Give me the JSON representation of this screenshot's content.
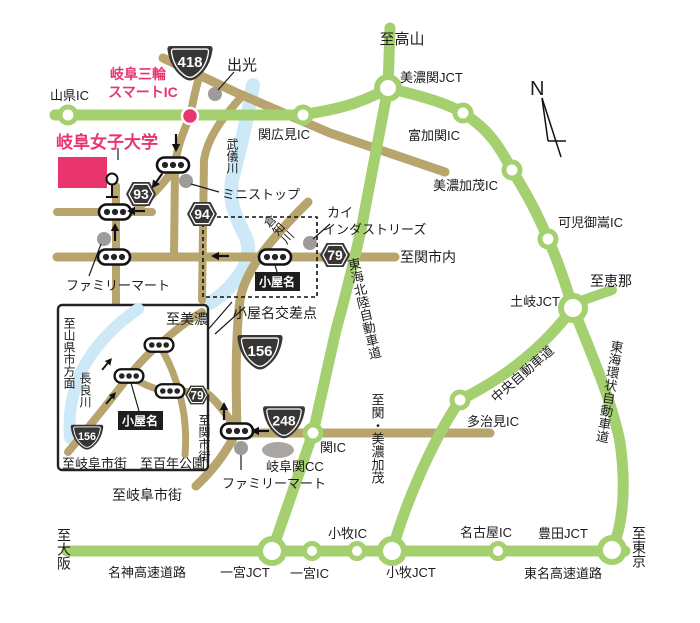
{
  "title": "岐阜女子大学 アクセスマップ",
  "colors": {
    "expressway_green": "#a4d070",
    "local_road_tan": "#b8a46d",
    "river_blue": "#cde9f7",
    "accent_pink": "#e8356d",
    "badge_dark": "#383634",
    "poi_gray": "#9e9b98"
  },
  "route_badges": {
    "national_routes": [
      "418",
      "156",
      "248"
    ],
    "prefectural_routes": [
      "93",
      "94",
      "79"
    ]
  },
  "labels": {
    "takayama": "至高山",
    "route_418": "418",
    "idemitsu": "出光",
    "gifu_miwa_line1": "岐阜三輪",
    "gifu_miwa_line2": "スマートIC",
    "yamagata_ic": "山県IC",
    "minoseki_jct": "美濃関JCT",
    "sekihiromi_ic": "関広見IC",
    "compass_n": "N",
    "tomikaseki_ic": "富加関IC",
    "gifu_womens_univ": "岐阜女子大学",
    "mukigawa": "武儀川",
    "ministop": "ミニストップ",
    "route_93": "93",
    "route_94": "94",
    "kai_line1": "カイ",
    "kai_line2": "インダストリーズ",
    "route_79": "79",
    "seki_shinai": "至関市内",
    "minokamo_ic": "美濃加茂IC",
    "kanimitake_ic": "可児御嵩IC",
    "ena": "至恵那",
    "toki_jct": "土岐JCT",
    "tokai_hokuriku": "東海北陸自動車道",
    "kurachigawa": "倉知川",
    "koyana": "小屋名",
    "koyana_kosaten": "小屋名交差点",
    "familymart_left": "ファミリーマート",
    "tokai_kanjo": "東海環状自動車道",
    "chuo_expwy": "中央自動車道",
    "tajimi_ic": "多治見IC",
    "route_156": "156",
    "route_248": "248",
    "seki_ic": "関IC",
    "gifuseki_cc": "岐阜関CC",
    "familymart_bottom": "ファミリーマート",
    "seki_minokamo": "至関・美濃加茂",
    "inset_mino": "至美濃",
    "inset_yamagata": "至山県市方面",
    "nagaragawa": "長良川",
    "inset_koyana": "小屋名",
    "inset_route_79": "79",
    "inset_route_156": "156",
    "inset_gifu_shigai": "至岐阜市街",
    "inset_hyakunen": "至百年公園",
    "inset_seki_shigai": "至関市街",
    "gifu_shigai": "至岐阜市街",
    "osaka": "至大阪",
    "meishin": "名神高速道路",
    "ichinomiya_jct": "一宮JCT",
    "ichinomiya_ic": "一宮IC",
    "komaki_ic": "小牧IC",
    "komaki_jct": "小牧JCT",
    "nagoya_ic": "名古屋IC",
    "toyota_jct": "豊田JCT",
    "tomei": "東名高速道路",
    "tokyo": "至東京"
  }
}
